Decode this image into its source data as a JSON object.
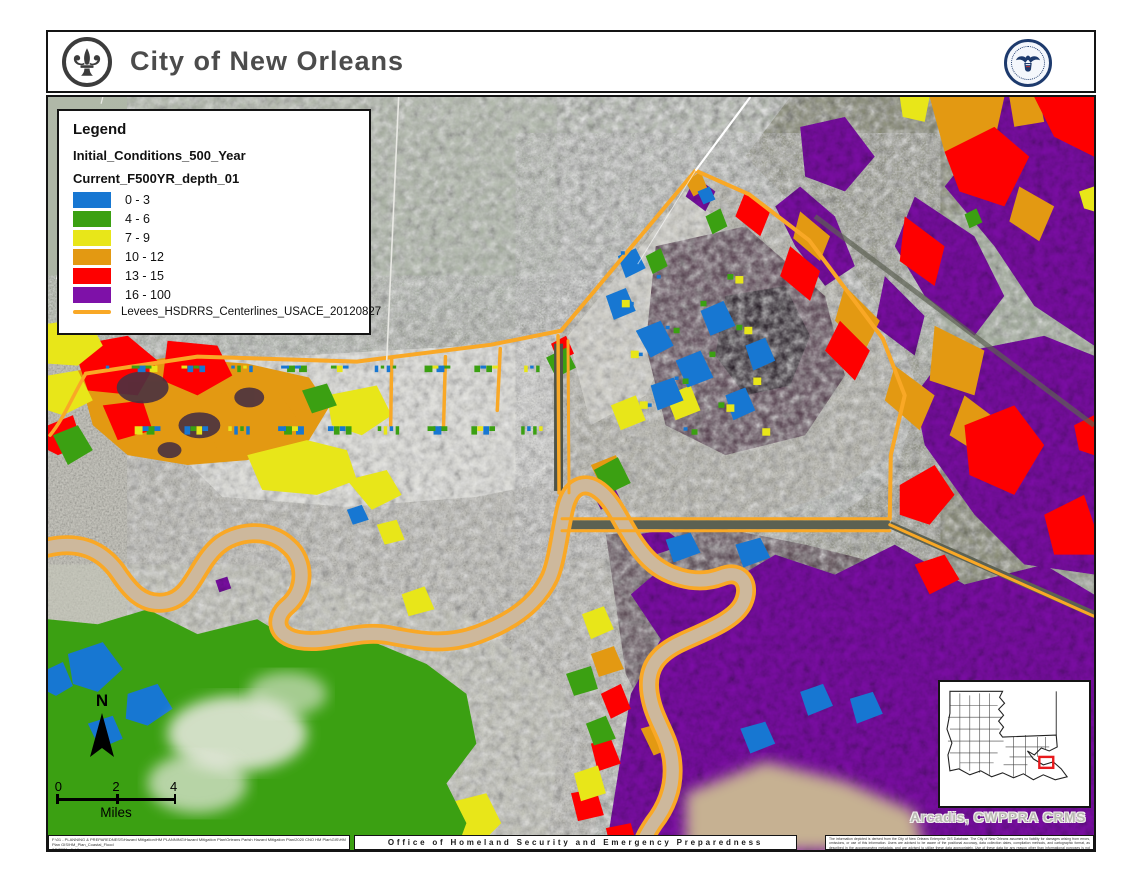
{
  "header": {
    "title": "City of New Orleans",
    "left_logo": "fleur-de-lis-seal",
    "right_logo": "new-orleans-homeland-security-seal"
  },
  "legend": {
    "title": "Legend",
    "layer_title": "Initial_Conditions_500_Year",
    "sublayer_title": "Current_F500YR_depth_01",
    "classes": [
      {
        "label": "0 - 3",
        "color": "#1777d2"
      },
      {
        "label": "4 - 6",
        "color": "#3ba012"
      },
      {
        "label": "7 - 9",
        "color": "#e8e619"
      },
      {
        "label": "10 - 12",
        "color": "#e39912"
      },
      {
        "label": "13 - 15",
        "color": "#fe0000"
      },
      {
        "label": "16 - 100",
        "color": "#7e11a8"
      }
    ],
    "line_item": {
      "label": "Levees_HSDRRS_Centerlines_USACE_20120827",
      "color": "#f9a826"
    }
  },
  "map": {
    "north_label": "N",
    "scale": {
      "ticks": [
        "0",
        "2",
        "4"
      ],
      "unit": "Miles"
    },
    "attribution": "Arcadis, CWPPRA CRMS"
  },
  "footer": {
    "path_line1": "F:\\01 - PLANNING & PREPAREDNESS\\Hazard Mitigation\\HM PLANNING\\Hazard Mitigation Plan\\Orleans Parish Hazard Mitigation Plan\\2020 CNO HM Plan\\GIS\\HM Plan GIS\\HM_Plan_Coastal_Flood",
    "path_line2": "8/5/2021  afieldhouse",
    "center_text": "Office of Homeland Security and Emergency Preparedness",
    "disclaimer": "The information depicted is derived from the City of New Orleans Enterprise GIS Database. The City of New Orleans assumes no liability for damages arising from errors, omissions, or use of this information. Users are advised to be aware of the positional accuracy, data collection dates, compilation methods, and cartographic format, as described in the accompanying metadata, and are advised to utilize these data appropriately. Use of these data for any reason other than informational purposes is not recommended, and the liabilities of such use are the sole responsibility of the user or redistributor of this data."
  }
}
